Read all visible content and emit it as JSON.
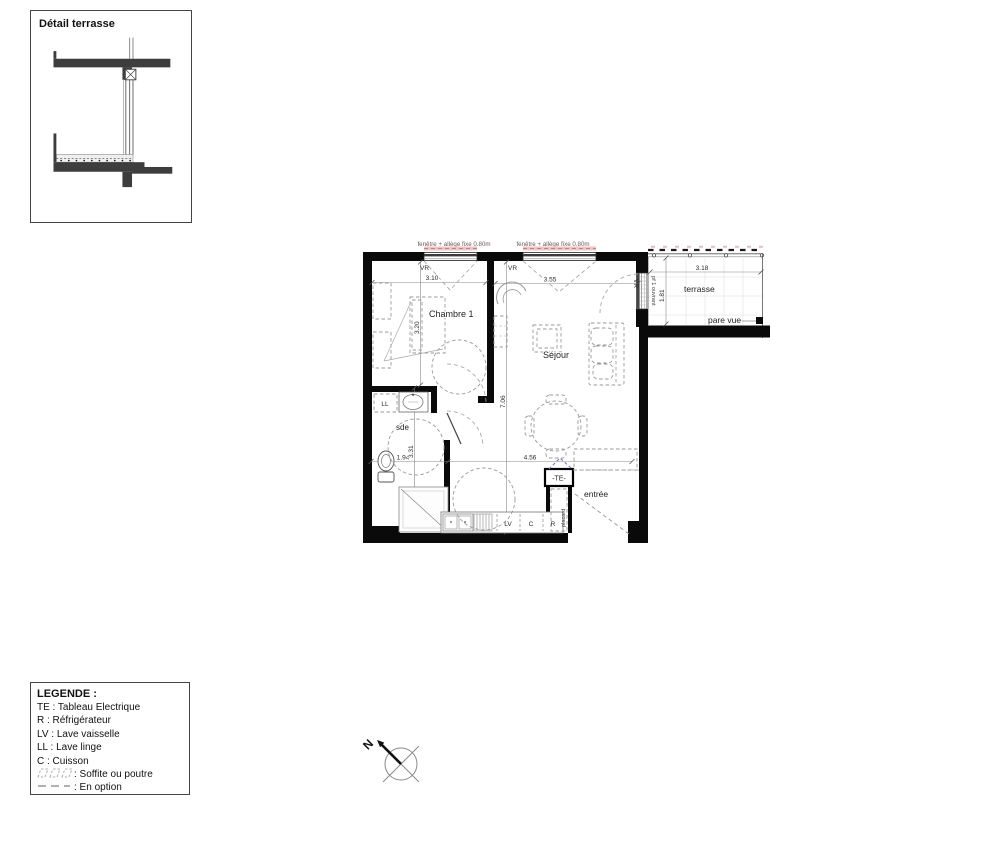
{
  "detail_box": {
    "title": "Détail terrasse"
  },
  "legend": {
    "title": "LEGENDE :",
    "items": [
      "TE : Tableau Electrique",
      "R : Réfrigérateur",
      "LV : Lave vaisselle",
      "LL : Lave linge",
      "C : Cuisson"
    ],
    "soffite": ": Soffite ou poutre",
    "option": ": En option"
  },
  "plan": {
    "window_annotation_left": "fenêtre + allège fixe 0.80m",
    "window_annotation_right": "fenêtre + allège fixe 0.80m",
    "vr_left": "VR",
    "vr_right": "VR",
    "vr_terrace": "VR",
    "pf_ouvrant": "pf 1 ouvrant",
    "room_chambre": "Chambre 1",
    "room_sejour": "Séjour",
    "room_sde": "sde",
    "room_entree": "entrée",
    "room_terrasse": "terrasse",
    "label_ll": "LL",
    "label_lv": "LV",
    "label_c": "C",
    "label_r": "R",
    "label_te": "-TE-",
    "label_placard": "placard",
    "label_pare_vue": "pare vue",
    "dim_chambre_w": "3.10",
    "dim_sejour_w": "3.55",
    "dim_chambre_h": "3.20",
    "dim_sejour_h": "7.06",
    "dim_sde_w": "1.94",
    "dim_sde_h": "3.31",
    "dim_kitchen_w": "4.56",
    "dim_terrasse_w": "3.18",
    "dim_terrasse_h": "1.81",
    "compass_north": "N"
  },
  "colors": {
    "wall": "#0a0a0a",
    "dashed_gray": "#9a9a9a",
    "window_pink": "#e9bcbc",
    "blue_duct": "#6b79cf"
  }
}
